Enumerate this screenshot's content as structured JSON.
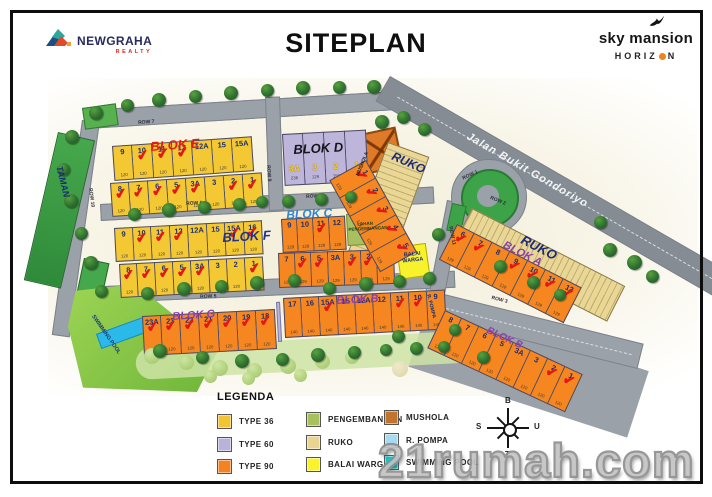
{
  "header": {
    "brand": {
      "name": "NEWGRAHA",
      "sub": "REALTY"
    },
    "title": "SITEPLAN",
    "project": {
      "name": "sky mansion",
      "sub_left": "HORIZ",
      "sub_right": "N"
    }
  },
  "watermark": "21rumah.com",
  "map": {
    "areas": {
      "taman": "TAMAN",
      "swimming_pool": "SWIMMING POOL",
      "mushola": "MUSHOLA",
      "lahan_line1": "LAHAN",
      "lahan_line2": "PENGEMBANGAN",
      "balai_line1": "BALAI",
      "balai_line2": "WARGA",
      "pompa": "R. POMPA",
      "ruko_top": "RUKO",
      "ruko_right": "RUKO",
      "jalan": "Jalan Bukit Gondoriyo"
    },
    "block_labels": [
      {
        "t": "BLOK E",
        "x": 150,
        "y": 140,
        "r": -4,
        "c": "#e31d1a",
        "fs": 13
      },
      {
        "t": "BLOK D",
        "x": 293,
        "y": 143,
        "r": -3,
        "c": "#15151a",
        "fs": 13
      },
      {
        "t": "BLOK F",
        "x": 222,
        "y": 231,
        "r": -3,
        "c": "#20318f",
        "fs": 13
      },
      {
        "t": "BLOK C",
        "x": 286,
        "y": 209,
        "r": -3,
        "c": "#2e86d4",
        "fs": 12
      },
      {
        "t": "BLOK G",
        "x": 172,
        "y": 312,
        "r": -4,
        "c": "#8a3fae",
        "fs": 11
      },
      {
        "t": "BLOK B",
        "x": 336,
        "y": 296,
        "r": -3,
        "c": "#8a3fae",
        "fs": 11
      },
      {
        "t": "BLOK A",
        "x": 506,
        "y": 240,
        "r": 27,
        "c": "#8a3fae",
        "fs": 11
      },
      {
        "t": "BLOK B",
        "x": 489,
        "y": 326,
        "r": 25,
        "c": "#8a3fae",
        "fs": 10
      }
    ],
    "road_labels": [
      {
        "t": "ROW 7",
        "x": 138,
        "y": 121,
        "r": -4
      },
      {
        "t": "ROW 6",
        "x": 186,
        "y": 202,
        "r": -3
      },
      {
        "t": "ROW 8",
        "x": 306,
        "y": 195,
        "r": -3
      },
      {
        "t": "ROW 5",
        "x": 200,
        "y": 295,
        "r": -2
      },
      {
        "t": "ROW 9",
        "x": 270,
        "y": 165,
        "r": 86
      },
      {
        "t": "ROW 10",
        "x": 92,
        "y": 188,
        "r": 82
      },
      {
        "t": "ROW 11",
        "x": 452,
        "y": 226,
        "r": 78
      },
      {
        "t": "ROW 1",
        "x": 462,
        "y": 177,
        "r": -25
      },
      {
        "t": "ROW 2",
        "x": 491,
        "y": 196,
        "r": 22
      },
      {
        "t": "ROW 3",
        "x": 492,
        "y": 296,
        "r": 14
      }
    ],
    "blocks": [
      {
        "id": "e-top",
        "color": "#f3c832",
        "x": 112,
        "y": 146,
        "rot": -4,
        "cw": 20,
        "ch": 35,
        "size": "120",
        "lots": [
          {
            "n": "9",
            "s": 0
          },
          {
            "n": "10",
            "s": 1
          },
          {
            "n": "11",
            "s": 1
          },
          {
            "n": "12",
            "s": 1
          },
          {
            "n": "12A",
            "s": 0
          },
          {
            "n": "15",
            "s": 0
          },
          {
            "n": "15A",
            "s": 0
          }
        ]
      },
      {
        "id": "e-bottom",
        "color": "#f3c832",
        "x": 110,
        "y": 183,
        "rot": -4,
        "cw": 19,
        "ch": 34,
        "size": "120",
        "lots": [
          {
            "n": "8",
            "s": 1
          },
          {
            "n": "7",
            "s": 1
          },
          {
            "n": "6",
            "s": 1
          },
          {
            "n": "5",
            "s": 1
          },
          {
            "n": "3A",
            "s": 1
          },
          {
            "n": "3",
            "s": 0
          },
          {
            "n": "2",
            "s": 1
          },
          {
            "n": "1",
            "s": 1
          }
        ]
      },
      {
        "id": "d",
        "color": "#bdb5da",
        "x": 282,
        "y": 134,
        "rot": -3,
        "cw": 21,
        "ch": 52,
        "style": "d",
        "lots": [
          {
            "n": "3A",
            "s": 0,
            "sz": "236"
          },
          {
            "n": "3",
            "s": 0,
            "sz": "129"
          },
          {
            "n": "2",
            "s": 0,
            "sz": "156"
          },
          {
            "n": "1",
            "s": 0,
            "sz": "129"
          }
        ]
      },
      {
        "id": "f-top",
        "color": "#f3c832",
        "x": 114,
        "y": 228,
        "rot": -3,
        "cw": 18.5,
        "ch": 34,
        "size": "120",
        "lots": [
          {
            "n": "9",
            "s": 0
          },
          {
            "n": "10",
            "s": 1
          },
          {
            "n": "11",
            "s": 1
          },
          {
            "n": "12",
            "s": 1
          },
          {
            "n": "12A",
            "s": 0
          },
          {
            "n": "15",
            "s": 0
          },
          {
            "n": "15A",
            "s": 1
          },
          {
            "n": "16",
            "s": 1
          }
        ]
      },
      {
        "id": "f-bottom",
        "color": "#f3c832",
        "x": 119,
        "y": 264,
        "rot": -3,
        "cw": 18,
        "ch": 34,
        "size": "120",
        "lots": [
          {
            "n": "8",
            "s": 1
          },
          {
            "n": "7",
            "s": 1
          },
          {
            "n": "6",
            "s": 1
          },
          {
            "n": "5",
            "s": 1
          },
          {
            "n": "3A",
            "s": 1
          },
          {
            "n": "3",
            "s": 0
          },
          {
            "n": "2",
            "s": 0
          },
          {
            "n": "1",
            "s": 1
          }
        ]
      },
      {
        "id": "c-top",
        "color": "#f6861f",
        "x": 281,
        "y": 219,
        "rot": -3,
        "cw": 16,
        "ch": 34,
        "size": "129",
        "lots": [
          {
            "n": "9",
            "s": 0
          },
          {
            "n": "10",
            "s": 0
          },
          {
            "n": "11",
            "s": 1
          },
          {
            "n": "12",
            "s": 0
          }
        ]
      },
      {
        "id": "c-bottom",
        "color": "#f6861f",
        "x": 278,
        "y": 253,
        "rot": -2,
        "cw": 16.5,
        "ch": 35,
        "size": "129",
        "lots": [
          {
            "n": "7",
            "s": 0
          },
          {
            "n": "6",
            "s": 1
          },
          {
            "n": "5",
            "s": 1
          },
          {
            "n": "3A",
            "s": 0
          },
          {
            "n": "3",
            "s": 1
          },
          {
            "n": "2",
            "s": 1
          },
          {
            "n": "1",
            "s": 0
          }
        ]
      },
      {
        "id": "g",
        "color": "#f6861f",
        "x": 142,
        "y": 316,
        "rot": -3,
        "cw": 19,
        "ch": 40,
        "size": "120",
        "lots": [
          {
            "n": "23A",
            "s": 1
          },
          {
            "n": "23",
            "s": 1
          },
          {
            "n": "22",
            "s": 1
          },
          {
            "n": "21",
            "s": 1
          },
          {
            "n": "20",
            "s": 1
          },
          {
            "n": "19",
            "s": 1
          },
          {
            "n": "18",
            "s": 1
          }
        ]
      },
      {
        "id": "b-strip",
        "color": "#f6861f",
        "x": 283,
        "y": 298,
        "rot": -3,
        "cw": 18,
        "ch": 40,
        "size": "140",
        "lots": [
          {
            "n": "17",
            "s": 0
          },
          {
            "n": "16",
            "s": 0
          },
          {
            "n": "15A",
            "s": 1
          },
          {
            "n": "15",
            "s": 0
          },
          {
            "n": "12A",
            "s": 0
          },
          {
            "n": "12",
            "s": 0
          },
          {
            "n": "11",
            "s": 1
          },
          {
            "n": "10",
            "s": 1
          },
          {
            "n": "9",
            "s": 0
          }
        ]
      },
      {
        "id": "b-corner",
        "color": "#f6861f",
        "x": 445,
        "y": 310,
        "rot": 25,
        "cw": 19,
        "ch": 42,
        "size": "120",
        "lots": [
          {
            "n": "8",
            "s": 0
          },
          {
            "n": "7",
            "s": 0
          },
          {
            "n": "6",
            "s": 0
          },
          {
            "n": "5",
            "s": 0
          },
          {
            "n": "3A",
            "s": 0
          },
          {
            "n": "3",
            "s": 0
          },
          {
            "n": "2",
            "s": 1
          },
          {
            "n": "1",
            "s": 1
          }
        ]
      },
      {
        "id": "a-upper",
        "color": "#f6861f",
        "x": 366,
        "y": 160,
        "rot": 61,
        "cw": 21,
        "ch": 42,
        "size": "129",
        "lots": [
          {
            "n": "1",
            "s": 1
          },
          {
            "n": "2",
            "s": 1
          },
          {
            "n": "3",
            "s": 1
          },
          {
            "n": "4",
            "s": 1
          },
          {
            "n": "5",
            "s": 1
          }
        ]
      },
      {
        "id": "a-lower",
        "color": "#f6861f",
        "x": 457,
        "y": 224,
        "rot": 27,
        "cw": 20,
        "ch": 40,
        "size": "129",
        "lots": [
          {
            "n": "6",
            "s": 1
          },
          {
            "n": "7",
            "s": 1
          },
          {
            "n": "8",
            "s": 0
          },
          {
            "n": "9",
            "s": 1
          },
          {
            "n": "10",
            "s": 1
          },
          {
            "n": "11",
            "s": 1
          },
          {
            "n": "12",
            "s": 1
          }
        ]
      }
    ],
    "trees": [
      [
        96,
        113,
        14
      ],
      [
        127,
        105,
        13
      ],
      [
        159,
        100,
        14
      ],
      [
        195,
        96,
        13
      ],
      [
        231,
        93,
        14
      ],
      [
        267,
        90,
        13
      ],
      [
        303,
        88,
        14
      ],
      [
        339,
        87,
        13
      ],
      [
        374,
        87,
        14
      ],
      [
        72,
        137,
        14
      ],
      [
        63,
        169,
        13
      ],
      [
        71,
        201,
        14
      ],
      [
        81,
        233,
        13
      ],
      [
        91,
        263,
        14
      ],
      [
        101,
        291,
        13
      ],
      [
        134,
        214,
        13
      ],
      [
        169,
        210,
        14
      ],
      [
        204,
        207,
        13
      ],
      [
        239,
        204,
        13
      ],
      [
        262,
        202,
        12
      ],
      [
        288,
        201,
        13
      ],
      [
        321,
        199,
        13
      ],
      [
        351,
        197,
        12
      ],
      [
        147,
        293,
        13
      ],
      [
        184,
        289,
        14
      ],
      [
        221,
        286,
        13
      ],
      [
        257,
        283,
        14
      ],
      [
        294,
        280,
        13
      ],
      [
        329,
        288,
        13
      ],
      [
        366,
        284,
        14
      ],
      [
        399,
        281,
        13
      ],
      [
        429,
        278,
        13
      ],
      [
        382,
        122,
        14
      ],
      [
        403,
        117,
        13
      ],
      [
        424,
        129,
        13
      ],
      [
        438,
        234,
        13
      ],
      [
        500,
        266,
        13
      ],
      [
        533,
        282,
        13
      ],
      [
        560,
        295,
        12
      ],
      [
        600,
        222,
        13
      ],
      [
        610,
        250,
        14
      ],
      [
        634,
        262,
        15
      ],
      [
        652,
        276,
        13
      ],
      [
        398,
        336,
        13
      ],
      [
        455,
        330,
        12
      ],
      [
        483,
        357,
        13
      ],
      [
        160,
        351,
        14
      ],
      [
        202,
        357,
        13
      ],
      [
        242,
        361,
        14
      ],
      [
        282,
        359,
        13
      ],
      [
        318,
        355,
        14
      ],
      [
        354,
        352,
        13
      ],
      [
        386,
        350,
        12
      ],
      [
        416,
        348,
        13
      ],
      [
        444,
        347,
        12
      ],
      [
        152,
        356,
        16,
        "p"
      ],
      [
        186,
        362,
        15,
        "p"
      ],
      [
        220,
        368,
        16,
        "p"
      ],
      [
        254,
        370,
        15,
        "p"
      ],
      [
        288,
        366,
        16,
        "p"
      ],
      [
        322,
        361,
        15,
        "p"
      ],
      [
        352,
        357,
        14,
        "p"
      ],
      [
        248,
        378,
        13,
        "p"
      ],
      [
        210,
        376,
        13,
        "p"
      ],
      [
        300,
        375,
        13,
        "p"
      ],
      [
        400,
        369,
        16,
        "s"
      ]
    ]
  },
  "legend": {
    "title": "LEGENDA",
    "columns": [
      {
        "x": 217,
        "y": 414,
        "items": [
          {
            "label": "TYPE 36",
            "color": "#f0c435"
          },
          {
            "label": "TYPE 60",
            "color": "#b9b3d9"
          },
          {
            "label": "TYPE 90",
            "color": "#f58220"
          }
        ]
      },
      {
        "x": 306,
        "y": 412,
        "items": [
          {
            "label": "PENGEMBANGAN",
            "color": "#a9c05f"
          },
          {
            "label": "RUKO",
            "color": "#e9d492"
          },
          {
            "label": "BALAI WARGA",
            "color": "#f8f32b"
          }
        ]
      },
      {
        "x": 384,
        "y": 410,
        "items": [
          {
            "label": "MUSHOLA",
            "color": "#c1742c"
          },
          {
            "label": "R. POMPA",
            "color": "#a8d9ef"
          },
          {
            "label": "SWIMMING POOL",
            "color": "#00cfd0"
          }
        ]
      }
    ]
  },
  "compass": {
    "top": "B",
    "left": "S",
    "right": "U",
    "bottom": "T"
  }
}
